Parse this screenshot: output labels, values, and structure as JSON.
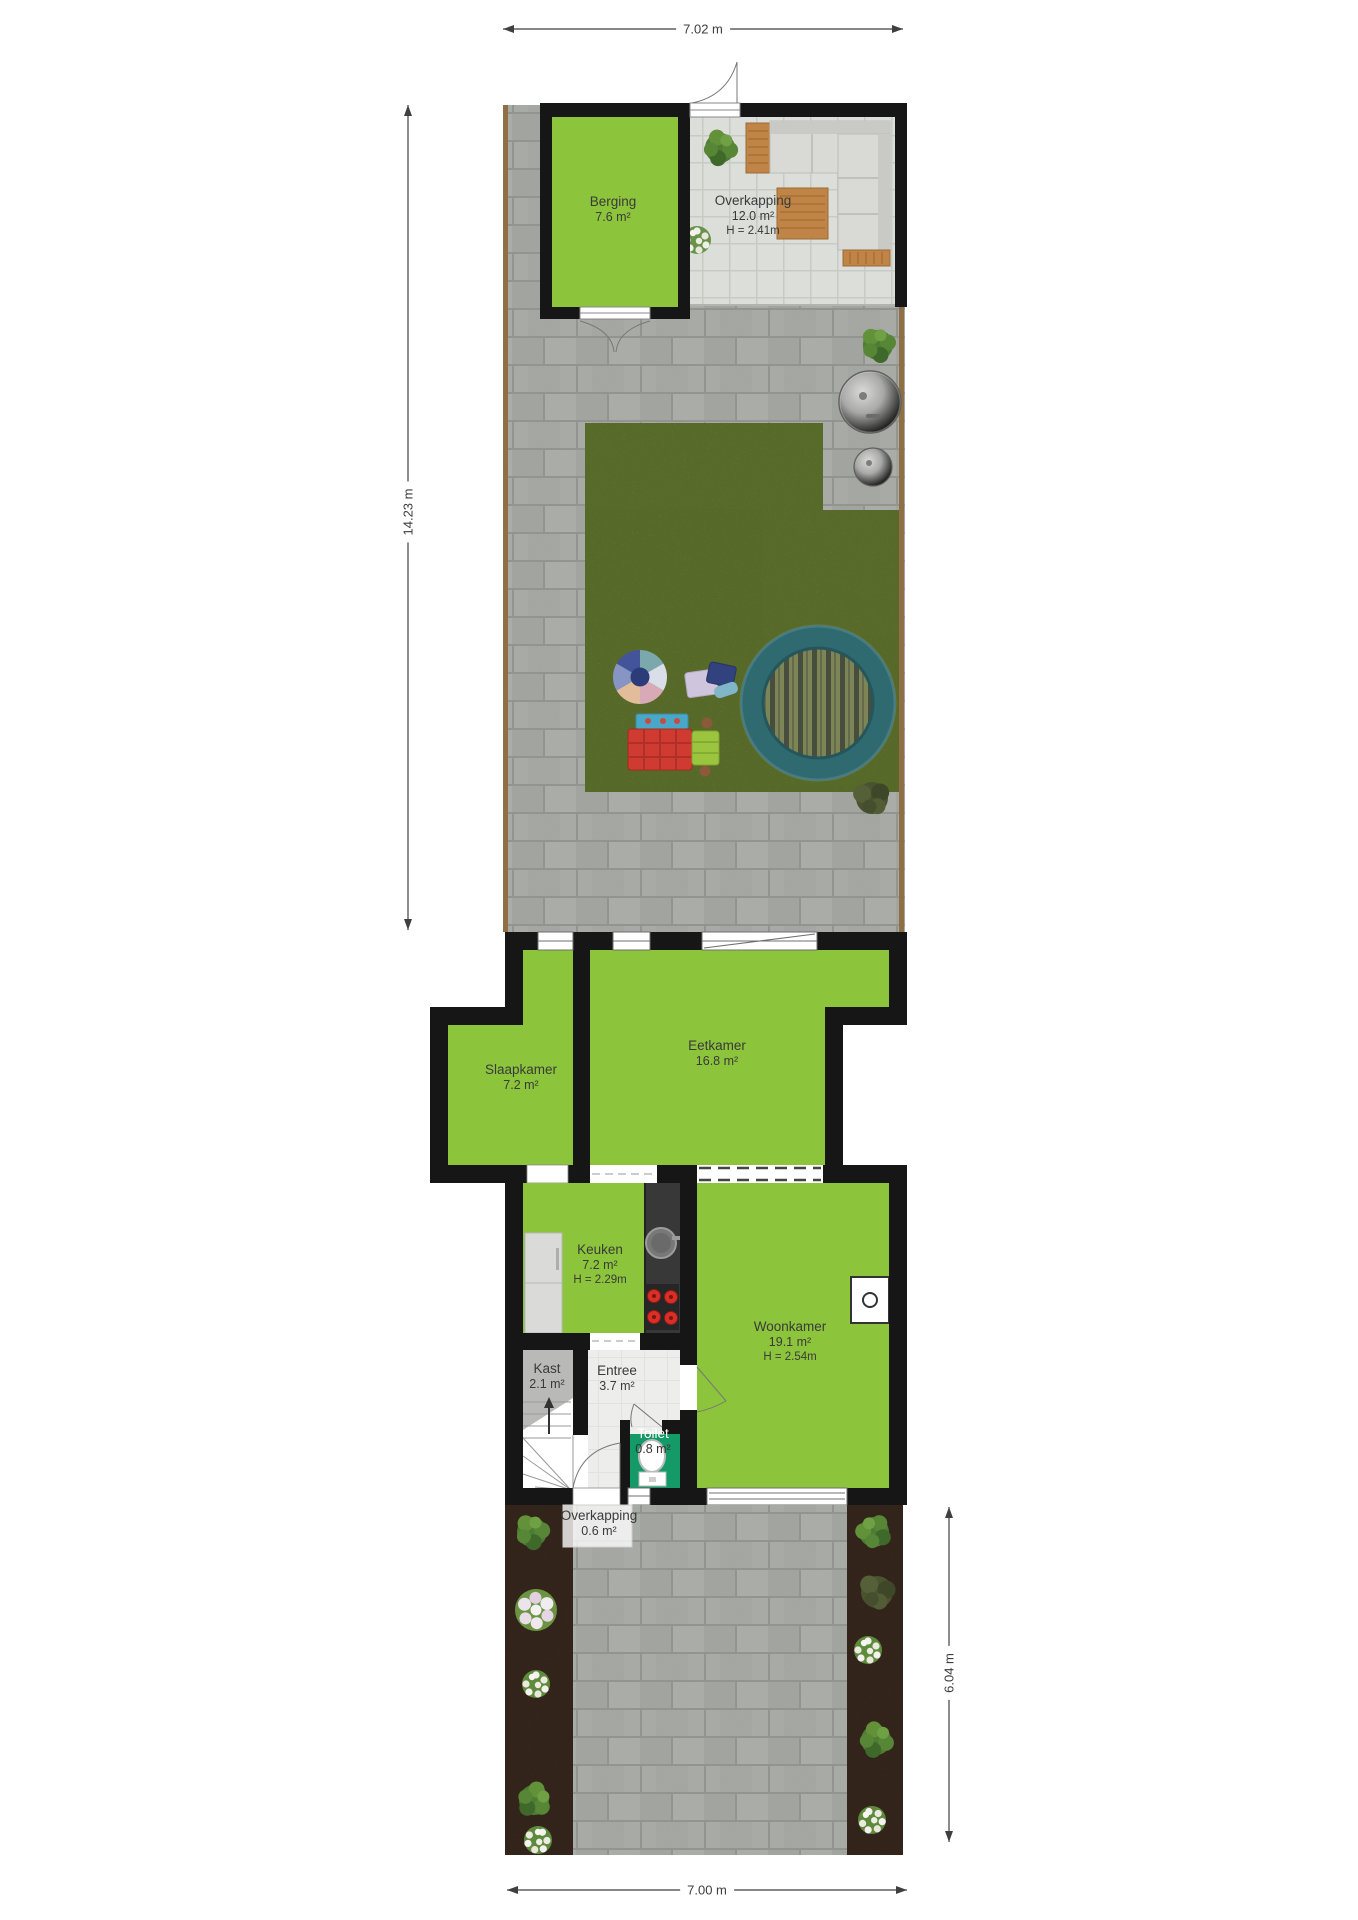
{
  "dimensions": {
    "width_top": "7.02 m",
    "depth_left": "14.23 m",
    "depth_right": "6.04 m",
    "width_bottom": "7.00 m"
  },
  "rooms": {
    "berging": {
      "name": "Berging",
      "area": "7.6 m²"
    },
    "overkapping_achter": {
      "name": "Overkapping",
      "area": "12.0 m²",
      "height": "H = 2.41m"
    },
    "slaapkamer": {
      "name": "Slaapkamer",
      "area": "7.2 m²"
    },
    "eetkamer": {
      "name": "Eetkamer",
      "area": "16.8 m²"
    },
    "keuken": {
      "name": "Keuken",
      "area": "7.2 m²",
      "height": "H = 2.29m"
    },
    "woonkamer": {
      "name": "Woonkamer",
      "area": "19.1 m²",
      "height": "H = 2.54m"
    },
    "kast": {
      "name": "Kast",
      "area": "2.1 m²"
    },
    "entree": {
      "name": "Entree",
      "area": "3.7 m²"
    },
    "toilet": {
      "name": "Toilet",
      "area": "0.8 m²"
    },
    "overkapping_voor": {
      "name": "Overkapping",
      "area": "0.6 m²"
    }
  },
  "colors": {
    "room_fill": "#8cc43c",
    "toilet_fill": "#149a66",
    "wall": "#161616",
    "grass": "#87a33f",
    "paver": "#bcbfb9",
    "canopy_tile": "#dcded9",
    "entree_tile": "#ededeb",
    "soil": "#50392b",
    "fence": "#8f6f45",
    "wood": "#c08448",
    "sofa": "#d9d9d6",
    "trampoline_ring": "#2f6a70"
  }
}
